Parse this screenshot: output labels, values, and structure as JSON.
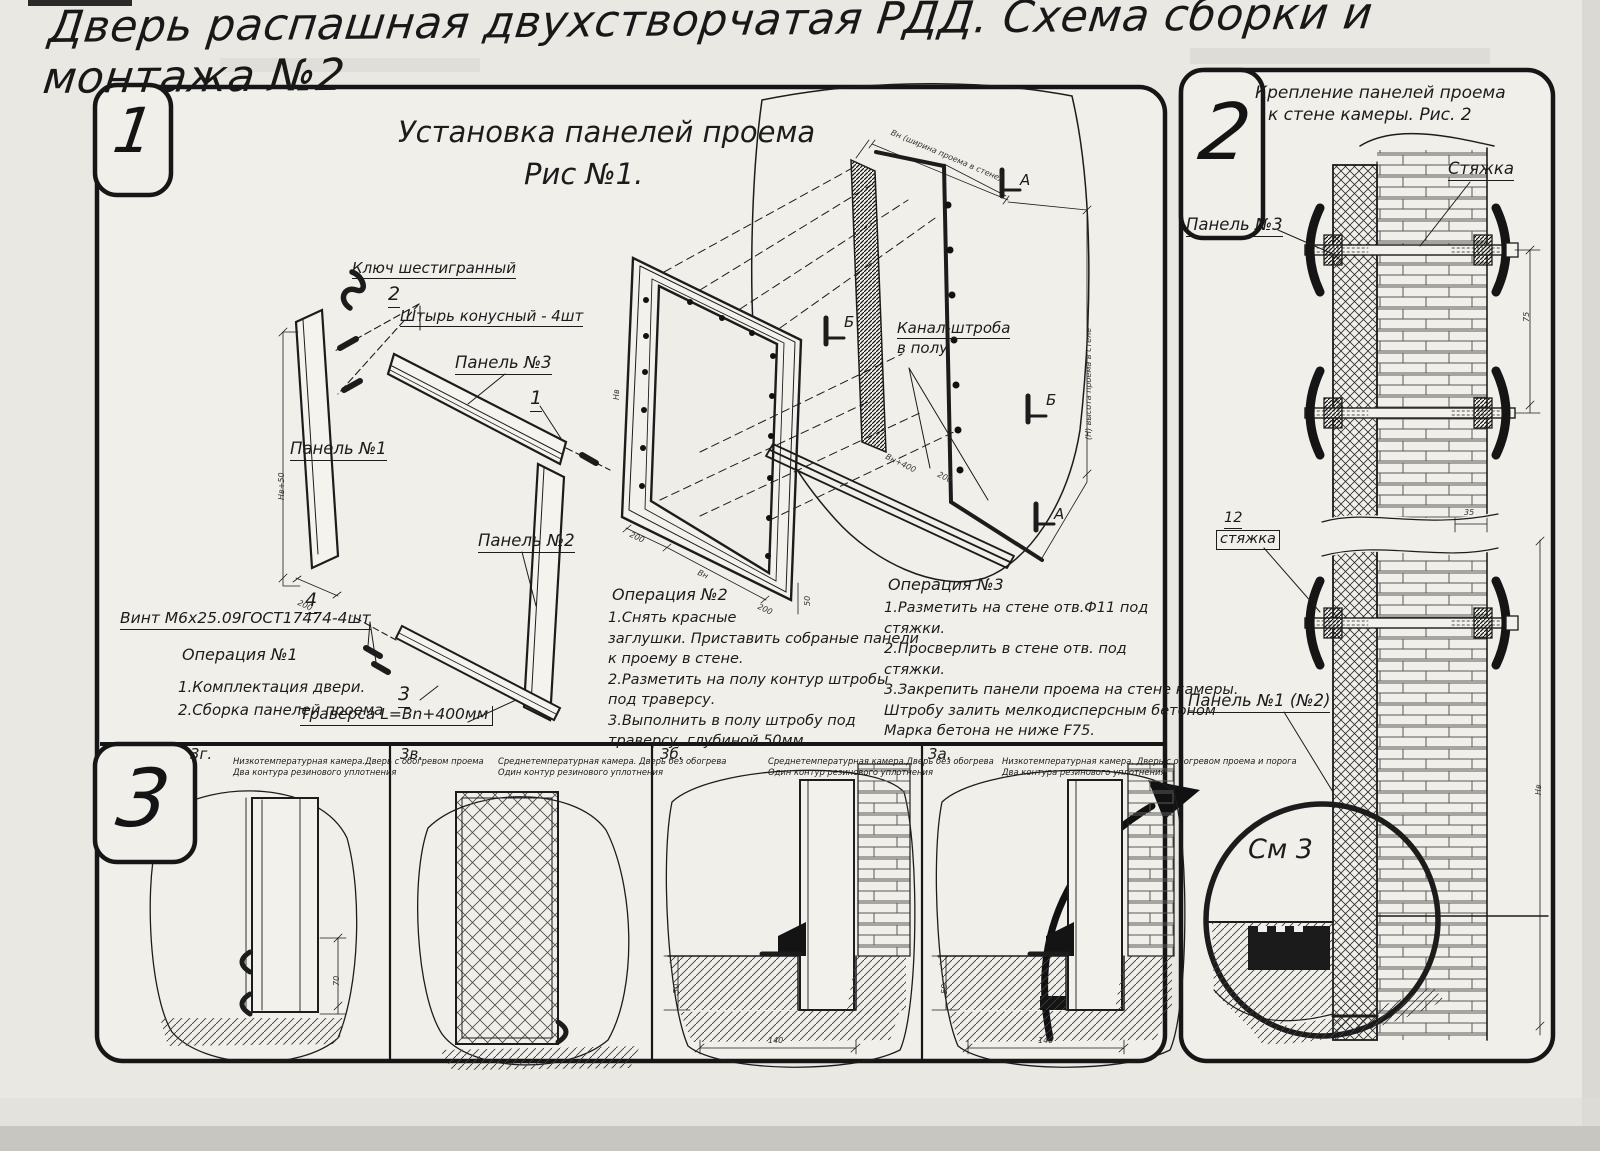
{
  "title": "Дверь распашная двухстворчатая РДД.  Схема сборки и монтажа №2",
  "section1": {
    "badge": "1",
    "heading1": "Установка панелей проема",
    "heading2": "Рис №1.",
    "labels": {
      "hex_key": "Ключ шестигранный",
      "pos2": "2",
      "pin": "Штырь конусный - 4шт",
      "panel3": "Панель №3",
      "pos1": "1",
      "panel1": "Панель №1",
      "panel2": "Панель №2",
      "pos4": "4",
      "screw": "Винт М6х25.09ГОСТ17474-4шт",
      "pos3": "3",
      "traverse": "Траверса  L=Bn+400мм",
      "channel_line1": "Канал-штроба",
      "channel_line2": "в полу",
      "marker_a": "А",
      "marker_b": "Б",
      "dim_top": "Вн (ширина проема в стене)",
      "dim_right": "(Н) высота проема в стене",
      "dim_hv50": "Нв+50",
      "dim_hv": "Нв",
      "dim_200": "200",
      "dim_bn": "Вн",
      "dim_50": "50",
      "dim_bn400": "Вн+400"
    },
    "op1": {
      "title": "Операция №1",
      "body": "1.Комплектация двери.\n2.Сборка панелей проема"
    },
    "op2": {
      "title": "Операция №2",
      "body": "1.Снять красные\nзаглушки. Приставить собраные панели\nк проему в стене.\n2.Разметить на полу контур штробы\nпод траверсу.\n3.Выполнить в полу штробу под\nтраверсу, глубиной 50мм."
    },
    "op3": {
      "title": "Операция №3",
      "body": "1.Разметить на стене отв.Ф11 под\nстяжки.\n2.Просверлить в стене отв.  под\nстяжки.\n3.Закрепить панели проема на стене камеры.\nШтробу залить мелкодисперсным бетоном\nМарка бетона не ниже   F75."
    }
  },
  "section2": {
    "badge": "2",
    "heading1": "Крепление панелей проема",
    "heading2": "к стене камеры. Рис. 2",
    "labels": {
      "tie": "Стяжка",
      "panel3": "Панель №3",
      "pos12": "12",
      "tie_small": "стяжка",
      "panel12": "Панель №1 (№2)",
      "see": "См 3",
      "dim75": "75",
      "dim35": "35",
      "dim_hv": "Нв"
    }
  },
  "section3": {
    "badge": "3",
    "panels": [
      {
        "code": "3г.",
        "desc": "Низкотемпературная камера.Дверь с обогревом проема\nДва контура резинового уплотнения",
        "dim_h": "70"
      },
      {
        "code": "3в.",
        "desc": "Среднетемпературная камера. Дверь без обогрева\nОдин контур резинового уплотнения"
      },
      {
        "code": "3б.",
        "desc": "Среднетемпературная камера.Дверь без обогрева\nОдин контур резинового уплотнения",
        "dim_h": "50",
        "dim_w": "140"
      },
      {
        "code": "3а.",
        "desc": "Низкотемпературная камера. Дверь с обогревом проема и порога\nДва контура резинового уплотнения",
        "dim_h": "50",
        "dim_w": "140"
      }
    ]
  }
}
